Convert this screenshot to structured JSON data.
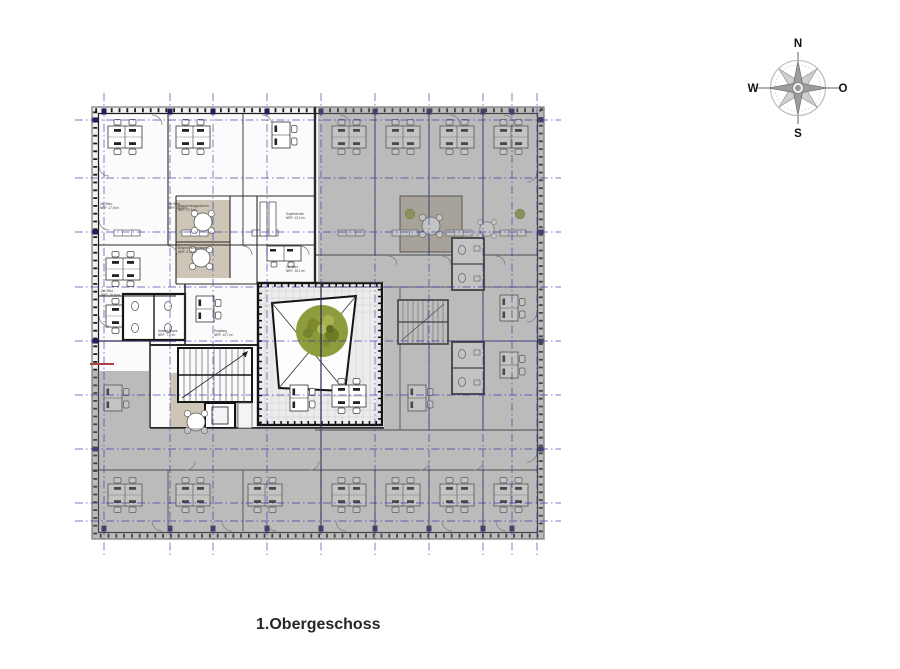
{
  "title": "1.Obergeschoss",
  "compass": {
    "n": "N",
    "e": "O",
    "s": "S",
    "w": "W"
  },
  "rooms": [
    {
      "label": "2er Büro",
      "area": "NRF: 17,5 m²"
    },
    {
      "label": "2er Büro",
      "area": "NRF: 16,6 m²"
    },
    {
      "label": "Besprechungszimmer",
      "area": "NRF: 27,6 m²"
    },
    {
      "label": "Abstell./Kopie",
      "area": "NRF: 7,6 m²"
    },
    {
      "label": "Empfang",
      "area": "NRF: 10,7 m²"
    },
    {
      "label": "2er Büro",
      "area": "NRF: 15,1 m²"
    },
    {
      "label": "Kopie/Archiv",
      "area": "NRF: 13,2 m²"
    }
  ],
  "colors": {
    "grid_blue": "#2d2da8",
    "overlay_gray": "rgba(122,122,122,0.45)",
    "tree_green": "#8f9c3d",
    "meeting_room_floor": "#cdc5b5",
    "wall": "#161616",
    "accent_red": "#b04040",
    "compass_gray": "#9c9c9c"
  }
}
